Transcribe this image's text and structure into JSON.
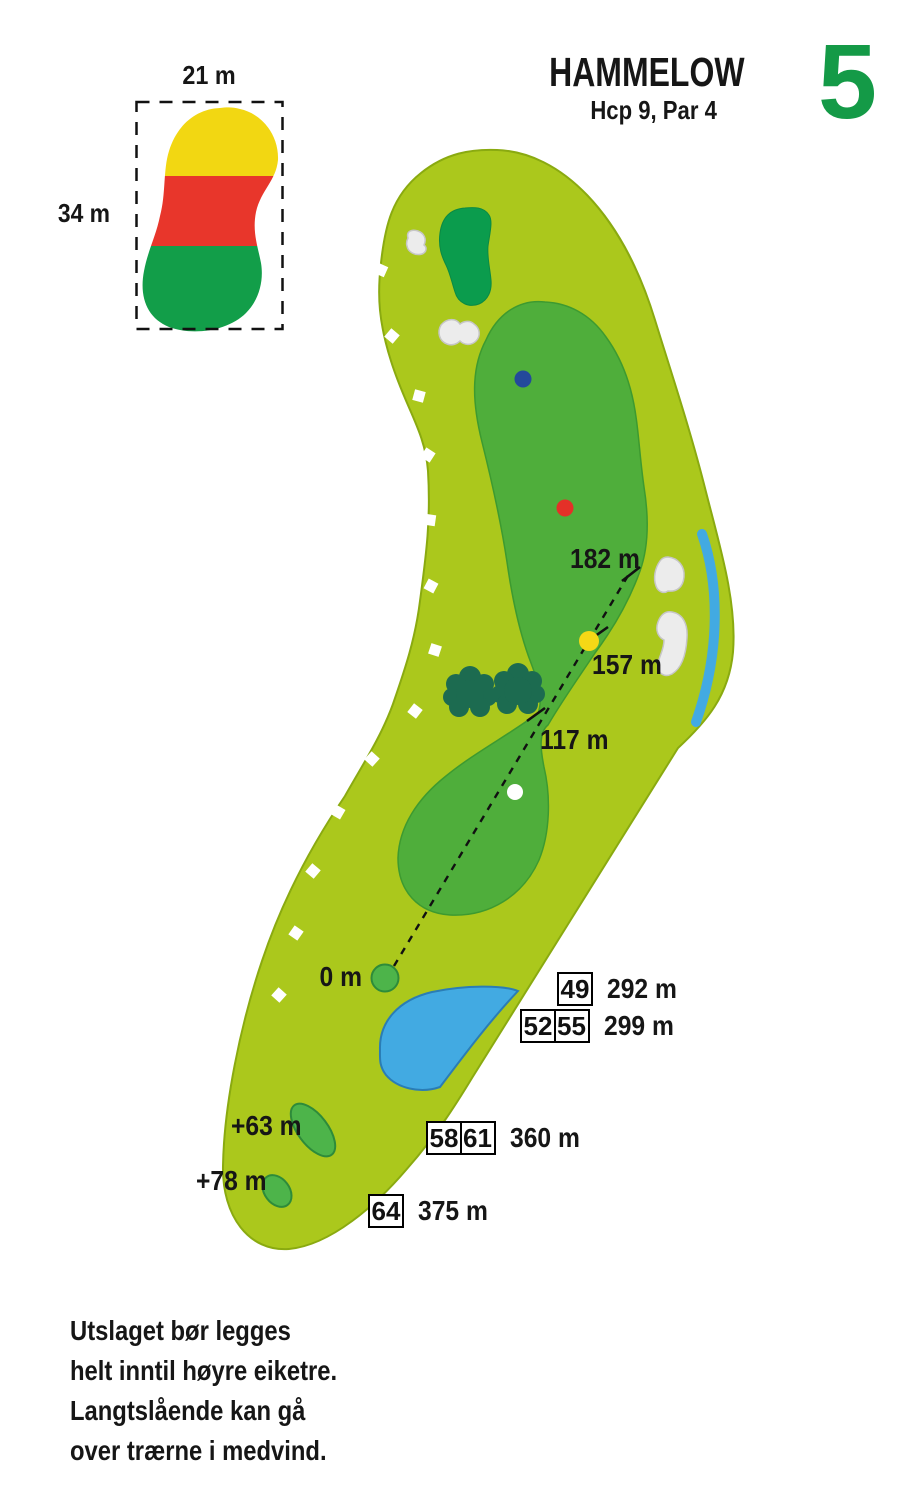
{
  "header": {
    "title": "HAMMELOW",
    "subtitle": "Hcp 9, Par 4",
    "hole_number": "5"
  },
  "green_inset": {
    "width_label": "21 m",
    "height_label": "34 m"
  },
  "map_labels": {
    "d182": "182 m",
    "d157": "157 m",
    "d117": "117 m",
    "tee_zero": "0 m",
    "tee_plus63": "+63 m",
    "tee_plus78": "+78 m"
  },
  "tee_table": {
    "rows": [
      {
        "boxes": [
          "49"
        ],
        "distance": "292 m"
      },
      {
        "boxes": [
          "52",
          "55"
        ],
        "distance": "299 m"
      },
      {
        "boxes": [
          "58",
          "61"
        ],
        "distance": "360 m"
      },
      {
        "boxes": [
          "64"
        ],
        "distance": "375 m"
      }
    ]
  },
  "note": {
    "lines": [
      "Utslaget bør legges",
      "helt inntil høyre eiketre.",
      "Langtslående kan gå",
      "over trærne i medvind."
    ]
  },
  "colors": {
    "rough": "#abc81c",
    "rough_outline": "#8aaa10",
    "fairway": "#4fae3b",
    "fairway_outline": "#3d9a30",
    "putting_green": "#0b9c4d",
    "tree": "#1c6b50",
    "water": "#42aae2",
    "water_outline": "#2a7db5",
    "bunker": "#ececec",
    "bunker_outline": "#c6c6c6",
    "tee_marker_fill": "#4db44a",
    "tee_marker_outline": "#2e8b3a",
    "dot_blue": "#24499b",
    "dot_red": "#e43028",
    "dot_yellow": "#f5d816",
    "dot_white": "#ffffff",
    "ob_marker_white": "#ffffff",
    "inset_back_zone": "#f2d712",
    "inset_middle_zone": "#e8362b",
    "inset_front_zone": "#129e49",
    "hole_number_green": "#149a47"
  }
}
